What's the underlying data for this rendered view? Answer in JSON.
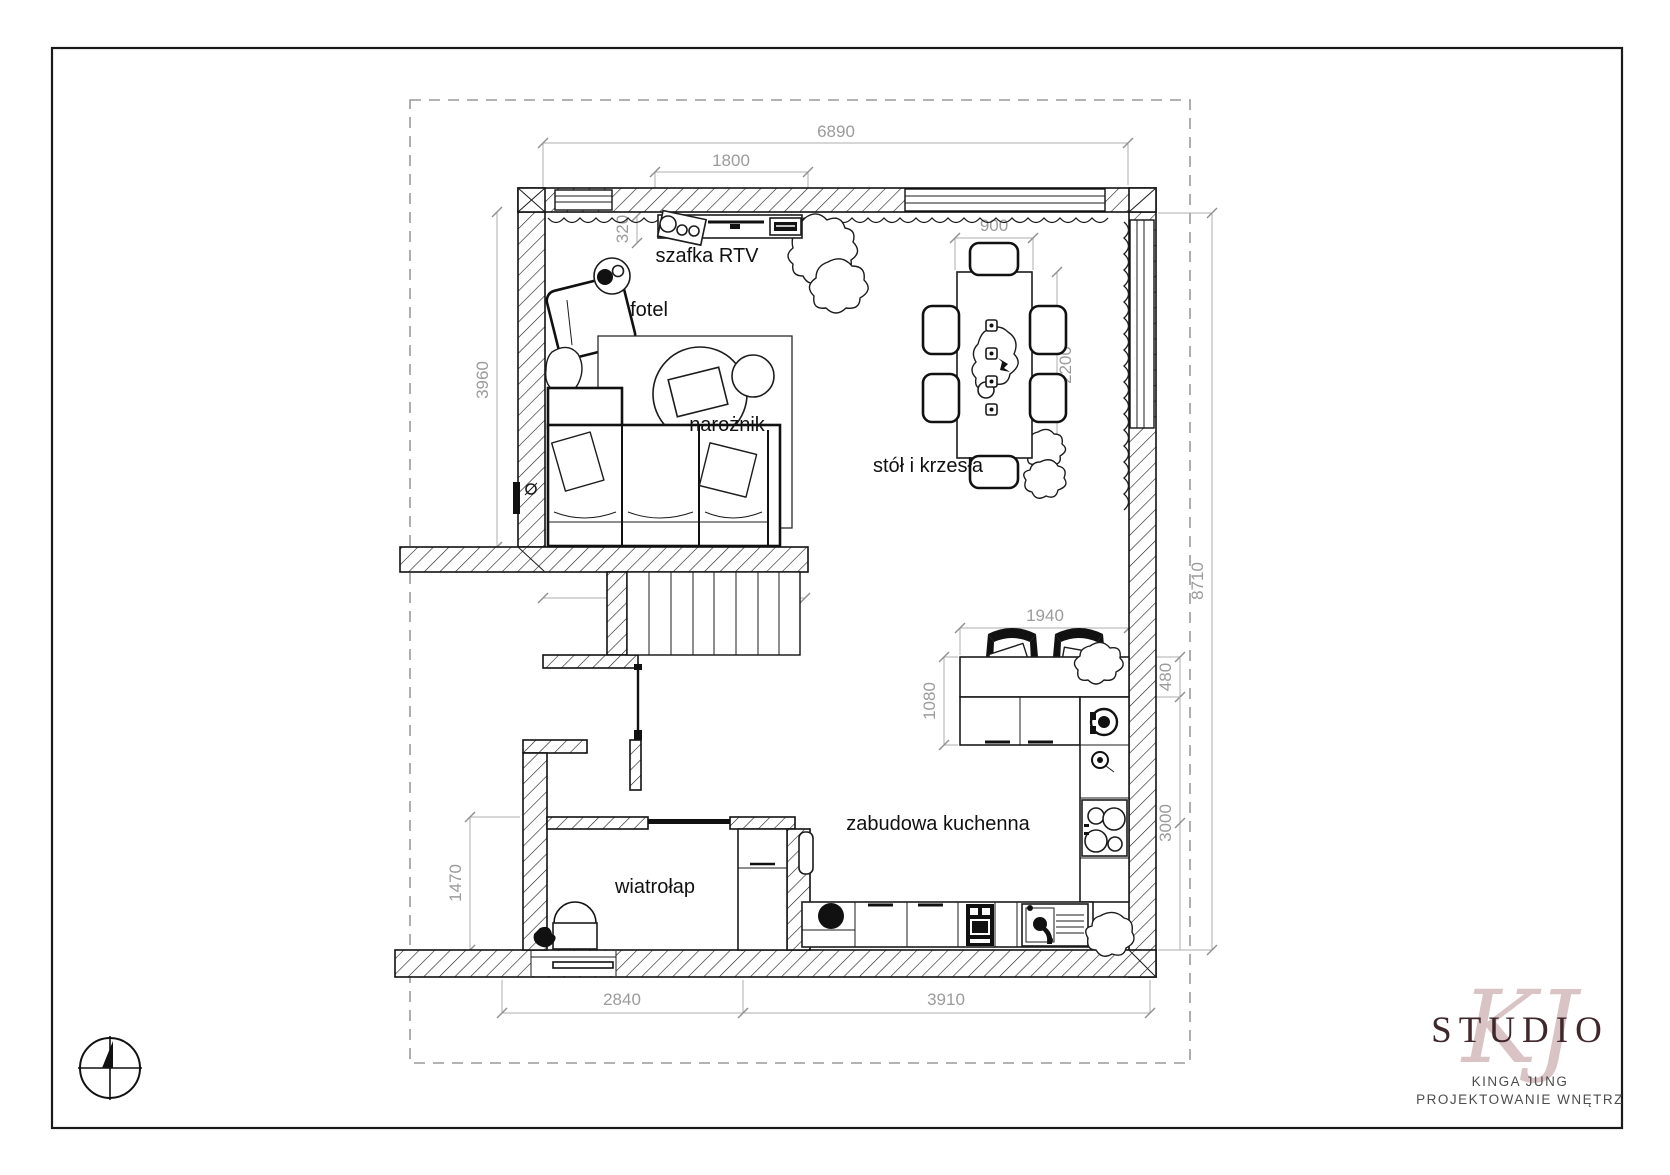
{
  "drawing": {
    "type": "interior floor plan",
    "rooms": {
      "rtv_cabinet": "szafka RTV",
      "armchair": "fotel",
      "corner_sofa": "narożnik",
      "dining_set": "stół i krzesła",
      "kitchen": "zabudowa kuchenna",
      "vestibule": "wiatrołap"
    },
    "dimensions_mm": {
      "top_total": "6890",
      "rtv_width": "1800",
      "rtv_depth": "320",
      "table_width": "900",
      "table_length": "2200",
      "living_left_height": "3960",
      "stair_opening": "3050",
      "right_total": "8710",
      "peninsula_width": "1940",
      "peninsula_depth": "1080",
      "counter_depth": "480",
      "kitchen_height": "3000",
      "vestibule_height": "1470",
      "bottom_left": "2840",
      "bottom_right": "3910"
    }
  },
  "logo": {
    "monogram": "KJ",
    "studio": "STUDIO",
    "author": "KINGA JUNG",
    "tagline": "PROJEKTOWANIE WNĘTRZ"
  },
  "colors": {
    "wall_line": "#111111",
    "dimension_gray": "#9b9b9b",
    "logo_rose": "#c7a4a6",
    "logo_maroon": "#3f272c",
    "boundary_dash": "#9a9a9a"
  }
}
